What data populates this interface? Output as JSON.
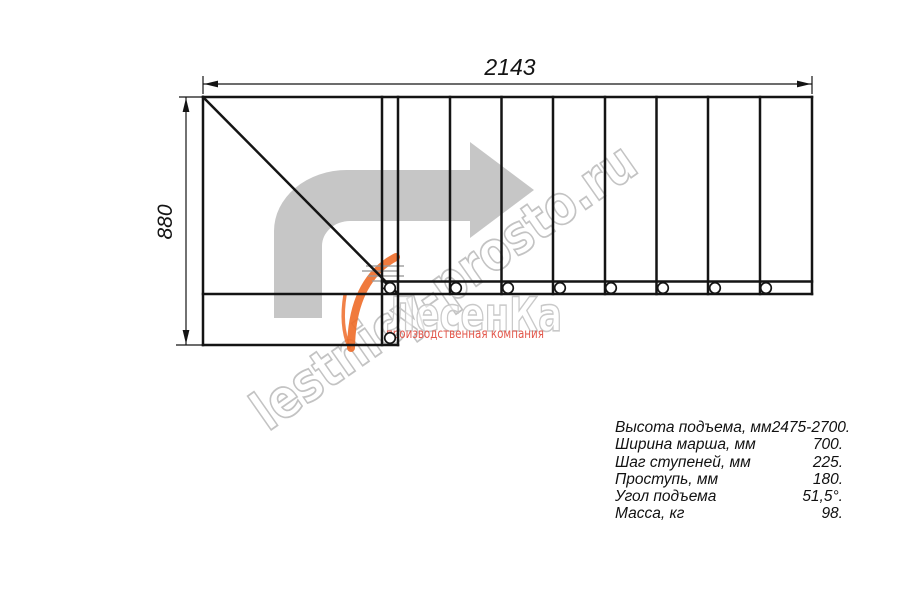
{
  "drawing": {
    "title": "staircase-plan-top-view",
    "dimensions": {
      "width_label": "2143",
      "height_label": "880"
    },
    "steps_straight_flight": 8,
    "direction_arrow": "up-then-right"
  },
  "watermark": {
    "text": "lestnicy-prosto.ru"
  },
  "logo": {
    "name": "ЛесенКа",
    "tagline": "производственная компания"
  },
  "spec": {
    "rows": [
      {
        "label": "Высота подъема, мм",
        "value": "2475-2700."
      },
      {
        "label": "Ширина марша, мм",
        "value": "700."
      },
      {
        "label": "Шаг ступеней, мм",
        "value": "225."
      },
      {
        "label": "Проступь, мм",
        "value": "180."
      },
      {
        "label": "Угол подъема",
        "value": "51,5°."
      },
      {
        "label": "Масса, кг",
        "value": "98."
      }
    ]
  },
  "colors": {
    "line_black": "#141414",
    "arrow_gray": "#c6c6c6",
    "watermark_gray": "#c3c3c3",
    "logo_outline_gray": "#c9c9c9",
    "tagline_red": "#e2574b",
    "swoosh_orange": "#ee6b28"
  }
}
